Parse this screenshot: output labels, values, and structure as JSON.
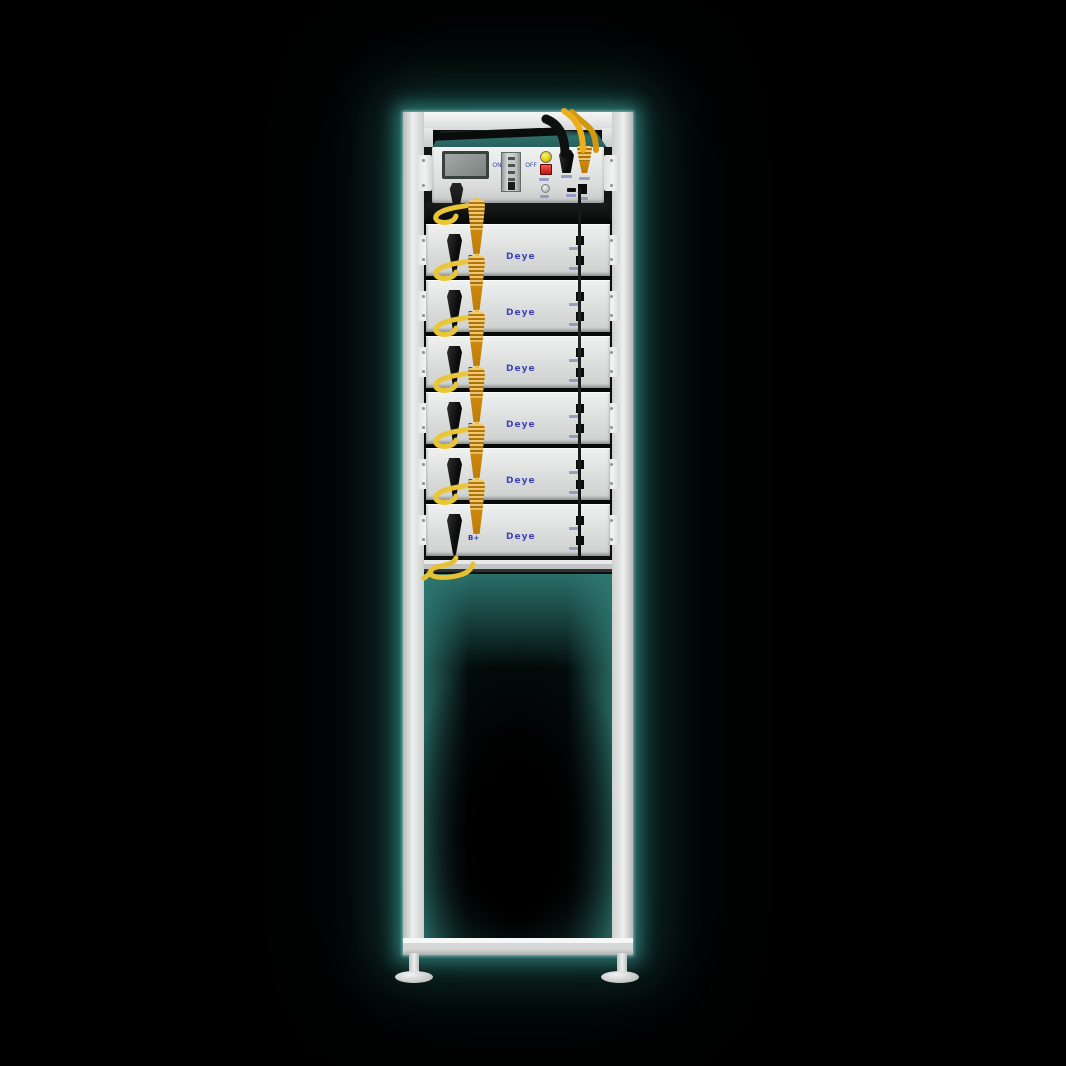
{
  "scene": {
    "description": "Deye stackable high-voltage battery energy storage tower on a white floor-stand rack, glowing teal against a black background",
    "background_color": "#000000",
    "glow_color": "#2f7a75",
    "frame_color": "#e9ebea",
    "module_face_color": "#e3e5e4",
    "cable_yellow": "#e8c435",
    "connector_orange": "#e39a16",
    "indicator_yellow": "#e6cf0a",
    "indicator_red": "#c0160f",
    "brand_blue": "#3c43b5",
    "control_top_teal": "#2d6e69"
  },
  "control_unit": {
    "display": {
      "type": "lcd-screen"
    },
    "power_switch": {
      "on_label": "ON",
      "off_label": "OFF"
    },
    "indicators": {
      "yellow_lamp": "run-indicator-lamp",
      "red_button": "stop-button",
      "round_button": "reset-button"
    },
    "connectors": {
      "left_plug": "dc-plug-black",
      "right_black_plug": "dc-plug-black",
      "right_orange_plug": "dc-plug-orange",
      "ports": [
        "comm-port-flat",
        "comm-port-square"
      ]
    }
  },
  "modules": [
    {
      "terminal_label": "B+",
      "brand_label": "Deye"
    },
    {
      "terminal_label": "B+",
      "brand_label": "Deye"
    },
    {
      "terminal_label": "B+",
      "brand_label": "Deye"
    },
    {
      "terminal_label": "B+",
      "brand_label": "Deye"
    },
    {
      "terminal_label": "B+",
      "brand_label": "Deye"
    },
    {
      "terminal_label": "B+",
      "brand_label": "Deye"
    }
  ],
  "stand": {
    "feet": 2
  }
}
